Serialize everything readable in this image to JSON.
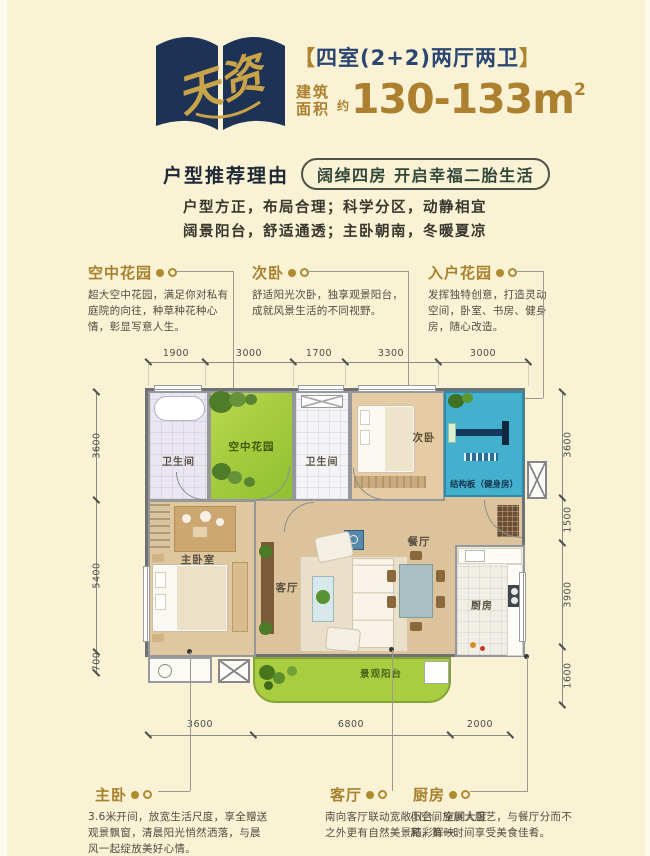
{
  "header": {
    "logo_text": "天资",
    "bracket_left": "【",
    "title": "四室(2+2)两厅两卫",
    "bracket_right": "】",
    "area_label_line1": "建筑",
    "area_label_line2": "面积",
    "area_approx": "约",
    "area_value": "130-133m",
    "area_sup": "2"
  },
  "recommend": {
    "label": "户型推荐理由",
    "pill": "阔绰四房 开启幸福二胎生活",
    "line1": "户型方正，布局合理；科学分区，动静相宜",
    "line2": "阔景阳台，舒适通透；主卧朝南，冬暖夏凉"
  },
  "callouts_top": [
    {
      "title": "空中花园",
      "desc": "超大空中花园，满足你对私有庭院的向往，种草种花种心情，彰显写意人生。"
    },
    {
      "title": "次卧",
      "desc": "舒适阳光次卧，独享观景阳台，成就风景生活的不同视野。"
    },
    {
      "title": "入户花园",
      "desc": "发挥独特创意，打造灵动空间，卧室、书房、健身房，随心改造。"
    }
  ],
  "callouts_bottom": [
    {
      "title": "主卧",
      "desc": "3.6米开间，放宽生活尺度，享全赠送观景飘窗，清晨阳光悄然洒落，与晨风一起绽放美好心情。"
    },
    {
      "title": "客厅",
      "desc": "南向客厅联动宽敞阳台，空间大度之外更有自然美景精彩辉映。"
    },
    {
      "title": "厨房",
      "desc": "小空间施展大厨艺，与餐厅分而不离，第一时间享受美食佳肴。"
    }
  ],
  "plan": {
    "rooms": {
      "bath1": "卫生间",
      "garden": "空中花园",
      "bath2": "卫生间",
      "bedroom2": "次卧",
      "gym": "结构板（健身房）",
      "master": "主卧室",
      "living": "客厅",
      "dining": "餐厅",
      "kitchen": "厨房",
      "balcony": "景观阳台"
    },
    "dims": {
      "top": [
        "1900",
        "3000",
        "1700",
        "3300",
        "3000"
      ],
      "left": [
        "3600",
        "5400",
        "700"
      ],
      "right": [
        "3600",
        "1500",
        "3900",
        "1600"
      ],
      "bottom": [
        "3600",
        "6800",
        "2000"
      ]
    }
  },
  "colors": {
    "navy": "#1d3254",
    "gold": "#ad8030",
    "cream": "#f9f2d4",
    "garden_green": "#a9ce41",
    "gym_teal": "#43b0cd"
  }
}
